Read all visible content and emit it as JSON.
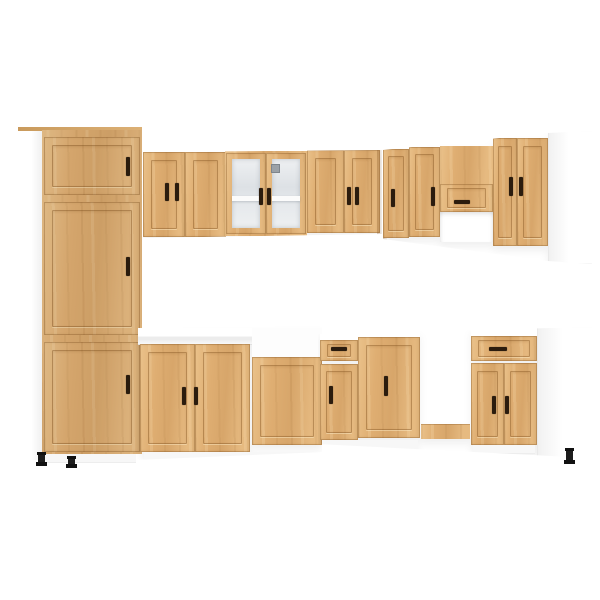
{
  "scene": {
    "description": "Product photo of an L-shaped kitchen cabinet set in artisan oak with white carcass sides, shaker-style doors, dark brown handles and black adjustable feet, on a plain white background",
    "background_color": "#ffffff"
  },
  "palette": {
    "wood_oak": "#dfae72",
    "wood_highlight": "#f0d4a4",
    "wood_shadow": "#c08b4f",
    "frame_line": "#7b4c1a",
    "carcass_white": "#fdfdfd",
    "edge_gray": "#e6e6e6",
    "glass_gray": "#e3e7ea",
    "shelf_white": "#fbfbfb",
    "handle_dark": "#2b1c0e",
    "foot_black": "#1d1d1d",
    "latch_metal": "#9ba1a7"
  },
  "components": {
    "tall_cabinet": {
      "label": "Tall fridge housing cabinet with three doors",
      "doors": 3,
      "handles": 3
    },
    "left_wall_run": {
      "label": "Left run of wall cabinets",
      "items": [
        {
          "label": "Two-door wall cabinet"
        },
        {
          "label": "Two-door glass wall cabinet with shelf and metal latch"
        },
        {
          "label": "Two-door wall cabinet at corner"
        }
      ]
    },
    "right_wall_run": {
      "label": "Right run of wall cabinets",
      "items": [
        {
          "label": "Corner wall cabinet door"
        },
        {
          "label": "Wall cabinet door"
        },
        {
          "label": "Flip-up door cabinet over extractor opening"
        },
        {
          "label": "Two-door wall cabinet"
        },
        {
          "label": "White carcass end panel"
        }
      ]
    },
    "left_base_run": {
      "label": "Left run of base cabinets",
      "items": [
        {
          "label": "Two-door sink base cabinet with white worktop"
        },
        {
          "label": "Wide appliance front panel below white carcass top"
        }
      ]
    },
    "right_base_run": {
      "label": "Right run of base cabinets",
      "items": [
        {
          "label": "Drawer-over-door base cabinet at corner"
        },
        {
          "label": "Single-door base cabinet"
        },
        {
          "label": "Open appliance gap with oak plinth"
        },
        {
          "label": "Drawer over two-door base cabinet"
        },
        {
          "label": "White carcass end panel"
        }
      ]
    },
    "counts": {
      "visible_doors": 17,
      "visible_drawers": 3,
      "visible_feet": 3,
      "glass_doors": 2
    }
  }
}
